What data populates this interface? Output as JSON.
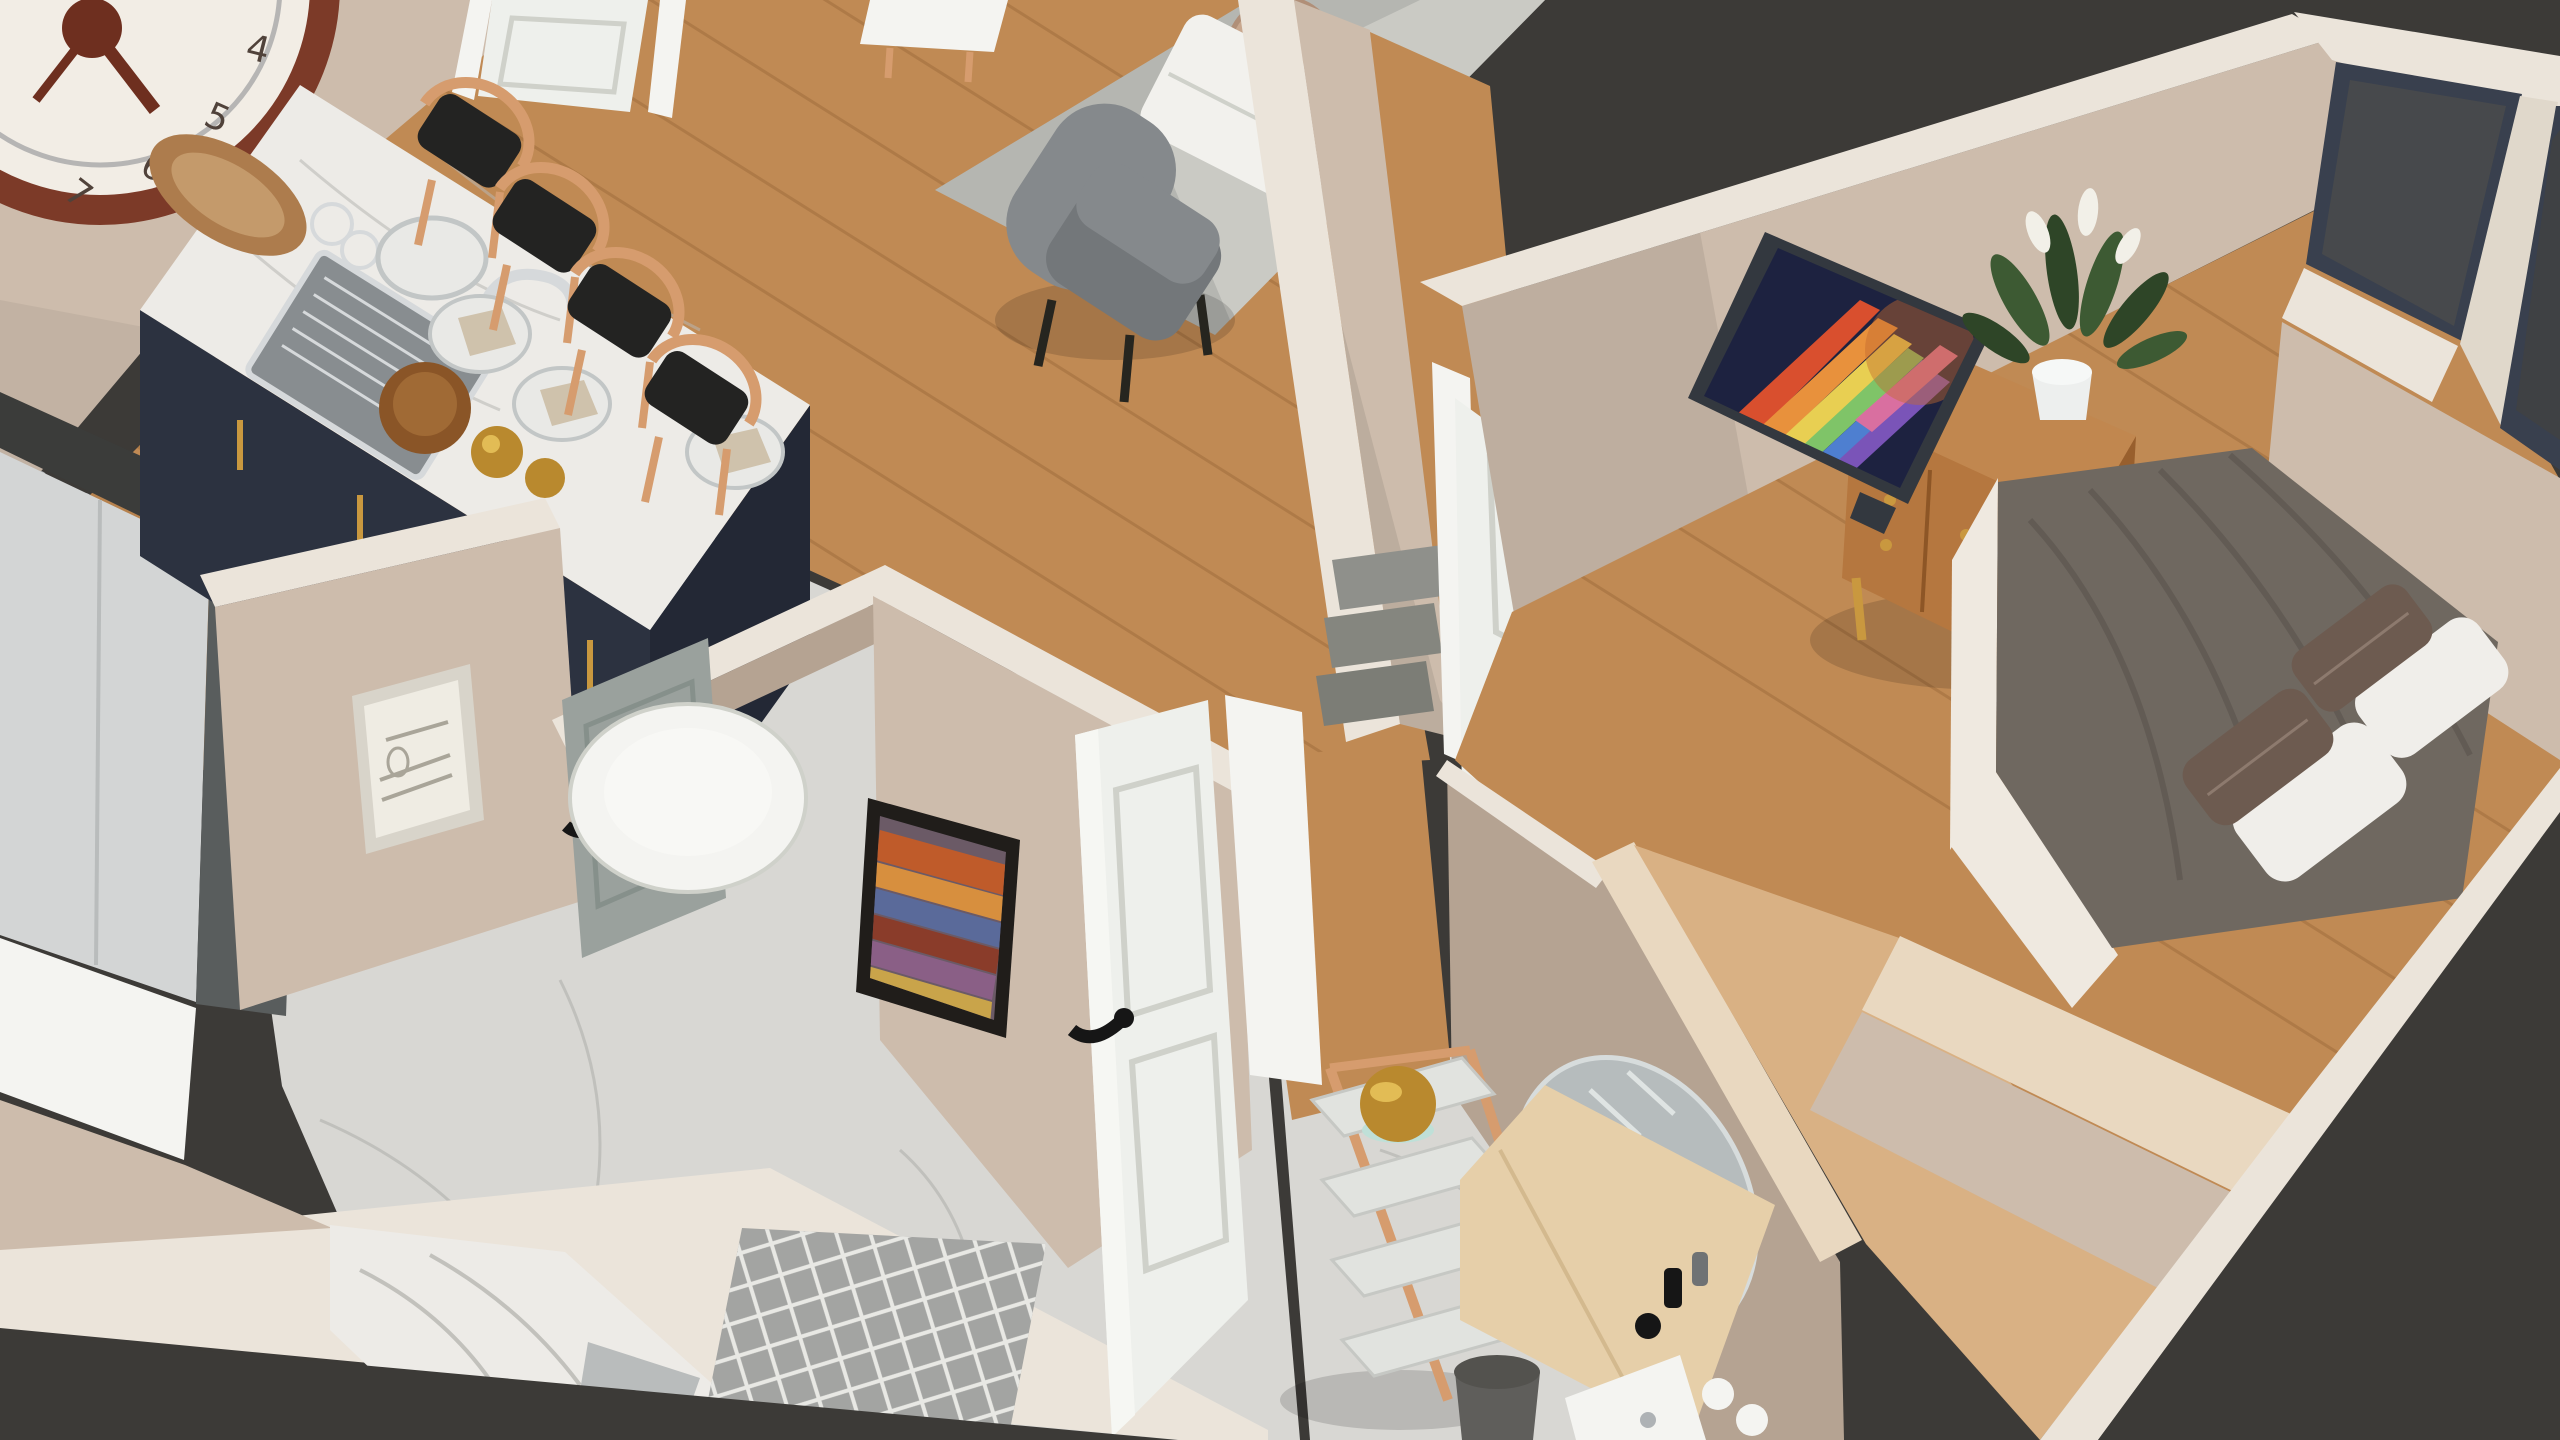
{
  "scene": {
    "kind": "3d-isometric-apartment-interior-render",
    "view": "top-down oblique cutaway (dollhouse view)",
    "background": "dark void outside apartment walls"
  },
  "palette": {
    "void": "#3c3a37",
    "wood": "#c08a54",
    "woodPale": "#d9b184",
    "woodCap": "#e9d8c0",
    "marbleFloor": "#d8d7d3",
    "marbleVein": "#b7b6b2",
    "marbleTop": "#edebe7",
    "wallFace": "#cdbcac",
    "wallFaceLight": "#dccfc0",
    "wallFaceDark": "#b5a392",
    "wallFaceDeep": "#a5927e",
    "wallTop": "#ebe4da",
    "wallTopDim": "#e0d8cb",
    "islandNavy": "#2c3240",
    "islandNavyDark": "#232835",
    "stoolWood": "#d69c6e",
    "seatBlack": "#232322",
    "rug": "#b5b6b1",
    "rugLight": "#ccccc7",
    "chairGray": "#85898c",
    "chairGrayDark": "#73777a",
    "sofaWhite": "#f2f1ed",
    "trayTan": "#c8a78e",
    "steel": "#aeb2b5",
    "steelDark": "#888d90",
    "chrome": "#d6d9db",
    "duvet": "#6f6860",
    "duvetDark": "#57504a",
    "pillowWhite": "#f0eeea",
    "pillowBrown": "#6d5b50",
    "bedFrame": "#efe9e0",
    "tvFrame": "#33383f",
    "tvScreen": "#1d2240",
    "console": "#b5773f",
    "consoleDark": "#985f2d",
    "brass": "#c9983f",
    "plant": "#3d5a33",
    "plantDark": "#2e4527",
    "flower": "#f2f0e8",
    "pot": "#edefee",
    "windowFrame": "#39404e",
    "pane": "#47494c",
    "paneDark": "#3f4144",
    "doorWhite": "#eef0ec",
    "doorPanel": "#e2e4de",
    "doorShadow": "#cfd1ca",
    "grayDoor": "#9aa19d",
    "black": "#161616",
    "gold": "#b9892e",
    "goldLight": "#e2bc55",
    "teal": "#bfe0d8",
    "shelfTray": "#e1e3df",
    "deskWood": "#e6cfa9",
    "mirror": "#b6bcbd",
    "bin": "#5f5e5b",
    "fridge": "#d3d5d5",
    "appliance": "#3b3c3a",
    "applianceGray": "#595d5d",
    "white": "#f4f4f1",
    "clockRim": "#7c3a28",
    "clockFace": "#f2ede5",
    "clockHand": "#6e2f1f",
    "artFrameBlack": "#201d1a",
    "artFrameLight": "#d8d4ca",
    "paper": "#efece3",
    "sketch": "#a9a599",
    "stepGray": "#8f908b",
    "latticeGray": "#a3a4a2",
    "latticeLine": "#e8e8e4",
    "napkin": "#cfc2ac",
    "plate": "#e9e9e6",
    "bowlWood": "#8a5527",
    "trayWood": "#ad7c4d"
  },
  "clock": {
    "numerals": [
      "4",
      "5",
      "6",
      "7"
    ]
  },
  "tv_streak_colors": [
    "#d94f2e",
    "#e8913c",
    "#e8cf52",
    "#7fc468",
    "#4e7fd0",
    "#7a54b8",
    "#d96fa0"
  ],
  "rooms": [
    {
      "id": "kitchen",
      "objects": [
        "marble island with sink and faucet",
        "navy island cabinets",
        "wooden serving tray",
        "wooden bowl",
        "plates with napkins",
        "gold vases",
        "glasses",
        "4 wishbone bar stools",
        "refrigerator",
        "dark cooktop counter",
        "wall clock",
        "entrance door"
      ]
    },
    {
      "id": "living-room",
      "objects": [
        "gray armchair",
        "white sofa",
        "round tan tray table",
        "gray rug",
        "white sideboard"
      ]
    },
    {
      "id": "hallway",
      "objects": [
        "open white interior door",
        "gray steps",
        "white bedroom door",
        "doorway to hall"
      ]
    },
    {
      "id": "bathroom",
      "objects": [
        "round white toilet",
        "gray door",
        "botanical sketch artwork",
        "abstract colorful artwork",
        "marble vanity with basin and faucet",
        "gray lattice rug",
        "marble floor"
      ]
    },
    {
      "id": "bedroom",
      "objects": [
        "bed with dark gray duvet",
        "2 white pillows",
        "2 brown accent pillows",
        "flat-screen TV with colorful abstract screen",
        "wooden media console with brass knobs",
        "peace lily plant in white pot",
        "2 dark windows",
        "closet walls",
        "light-wood wardrobe"
      ]
    },
    {
      "id": "entry",
      "objects": [
        "ladder shelf with 4 trays",
        "gold bowl",
        "light-wood vanity desk",
        "oval mirror",
        "cosmetic bottles",
        "white cups",
        "dark trash bin",
        "white fixture"
      ]
    }
  ]
}
